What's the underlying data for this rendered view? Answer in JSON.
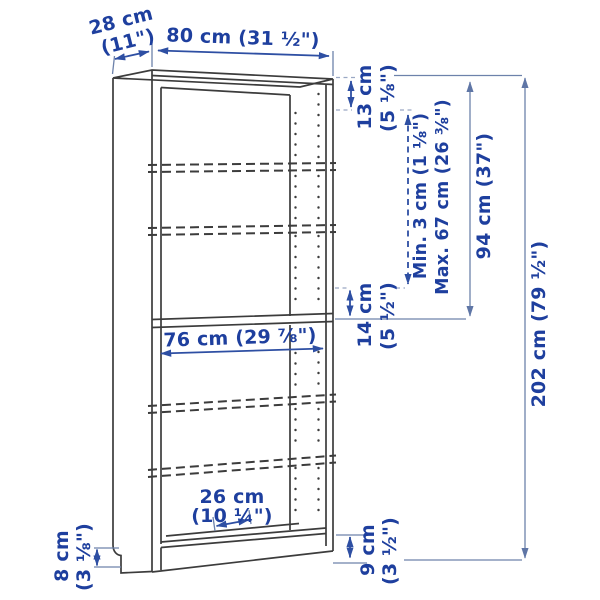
{
  "diagram": {
    "type": "product-dimension-diagram",
    "subject": "bookcase with adjustable shelves",
    "colors": {
      "label_text": "#1e3f9e",
      "arrow": "#2e4fa3",
      "dimension_line": "#6d82ab",
      "leader_line": "#9aa8c4",
      "drawing_line": "#3c3c3c",
      "background": "#ffffff"
    },
    "labels": {
      "depth_l1": "28 cm",
      "depth_l2": "(11\")",
      "width": "80 cm (31 ½\")",
      "top_gap_l1": "13 cm",
      "top_gap_l2": "(5 ⅛\")",
      "shelf_min": "Min. 3 cm (1 ⅛\")",
      "shelf_max": "Max. 67 cm (26 ⅜\")",
      "upper_section_height": "94 cm (37\")",
      "total_height": "202 cm (79 ½\")",
      "mid_gap_l1": "14 cm",
      "mid_gap_l2": "(5 ½\")",
      "inner_width": "76 cm (29 ⅞\")",
      "shelf_depth_l1": "26 cm",
      "shelf_depth_l2": "(10 ¼\")",
      "base_height_side_l1": "8 cm",
      "base_height_side_l2": "(3 ⅛\")",
      "base_height_front_l1": "9 cm",
      "base_height_front_l2": "(3 ½\")"
    }
  }
}
